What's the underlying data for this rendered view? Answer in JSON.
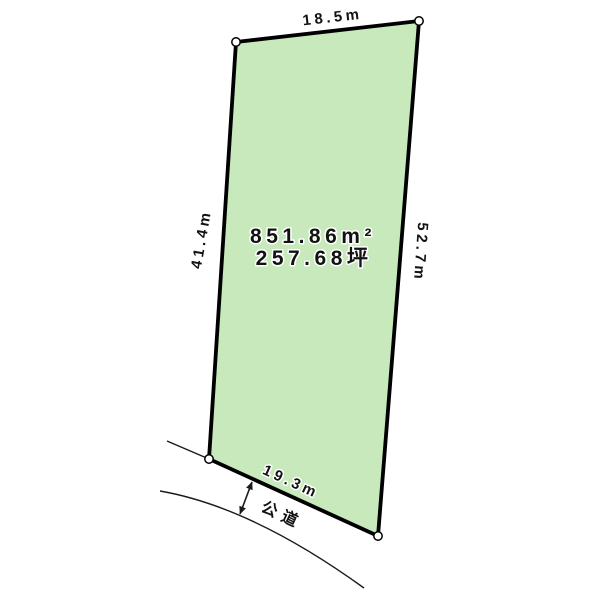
{
  "diagram": {
    "plot": {
      "top_edge_label": "18.5m",
      "left_edge_label": "41.4m",
      "right_edge_label": "52.7m",
      "bottom_edge_label": "19.3m",
      "area_m2": "851.86m²",
      "area_tsubo": "257.68坪"
    },
    "road": {
      "label": "公道"
    },
    "colors": {
      "plot_fill": "#c7e9bc",
      "outline": "#000000",
      "text": "#121212"
    }
  }
}
